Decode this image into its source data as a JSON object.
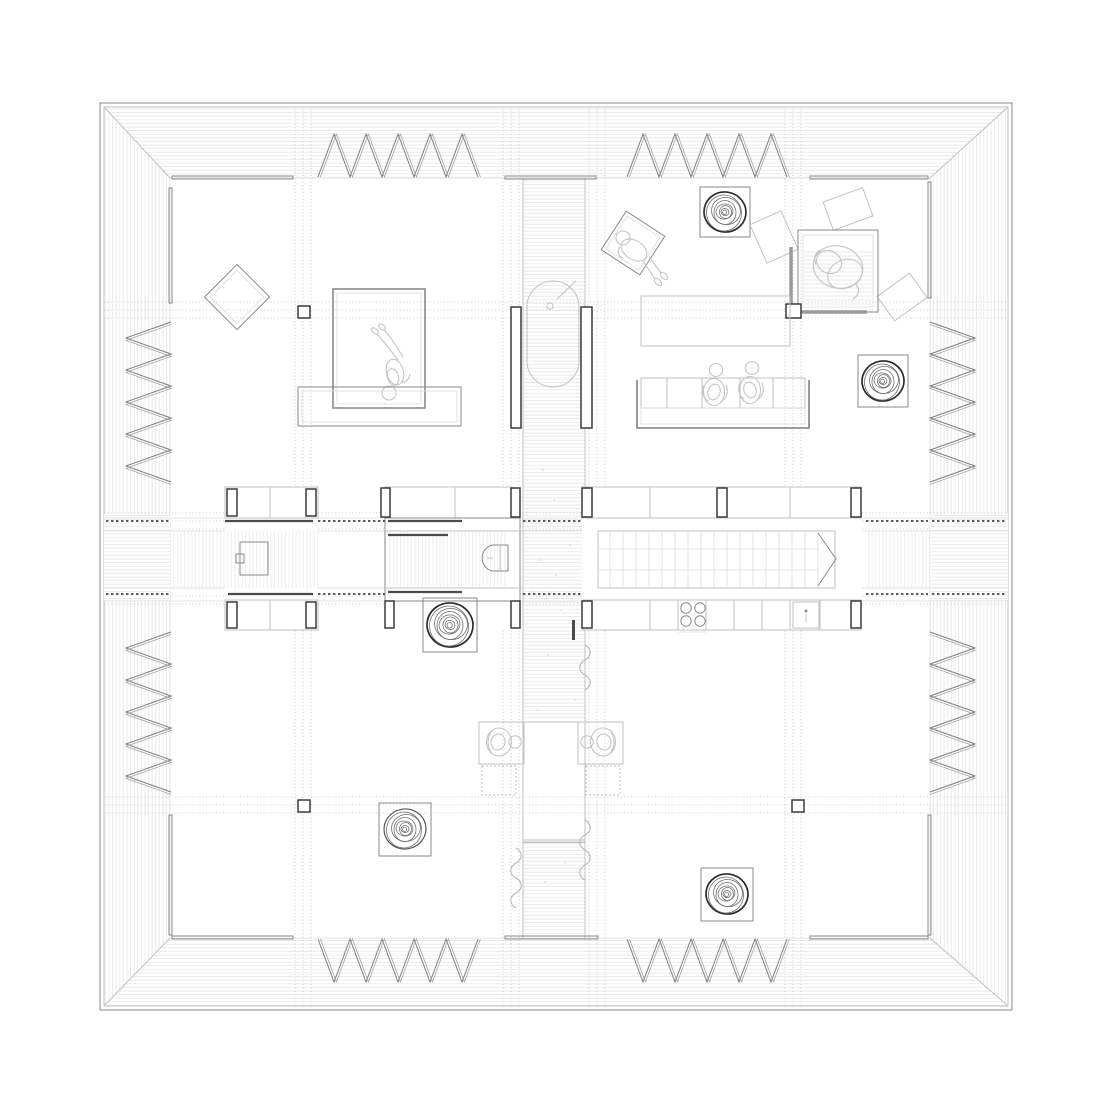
{
  "palette": {
    "background": "#ffffff",
    "ink_dark": "#2b2b2b",
    "ink": "#8a8a8a",
    "ink_light": "#c2c2c2",
    "hatch": "#e2e2e2",
    "grid_dots": "#bdbdbd",
    "people": "#c5c5c5",
    "wall_post": "#3a3a3a"
  },
  "plan": {
    "type": "architectural floor plan, top view, monochrome line drawing, no text labels",
    "building": "square pavilion: deep hatched roof/deck border, inner square floor, central deck corridor, full-width central service band",
    "counts": {
      "louver_screen_groups": 8,
      "louver_teeth_per_group": 5,
      "spiral_rugs": 5,
      "stair_treads": 17,
      "cooktop_burners": 4,
      "people_figures": 6,
      "column_markers": 4,
      "curtain_squiggles": 3,
      "scatter_cushions": 3
    },
    "features": [
      {
        "name": "deck-frame",
        "description": "double-line outer square with hatched eave band and mitred corners"
      },
      {
        "name": "louver-screens",
        "description": "accordion zigzag screens, two groups per side, between eave and glazing line"
      },
      {
        "name": "glazed-sills",
        "description": "short double-line sill segments on the inner wall line"
      },
      {
        "name": "grid-lines",
        "description": "dotted construction grid clusters crossing the plan"
      },
      {
        "name": "central-corridor",
        "description": "vertical plank-hatched deck strip through the whole plan"
      },
      {
        "name": "bathtub",
        "description": "freestanding oval tub on corridor with drain and diagonal faucet, flanked by two dark privacy walls"
      },
      {
        "name": "dining-table",
        "description": "corridor-width table with two facing seated figures and dotted floor cushions"
      },
      {
        "name": "curtains",
        "description": "wavy curtain lines along corridor edges"
      },
      {
        "name": "west-bed",
        "description": "double-line bed with lying figure, low bench below, rotated lounge chair"
      },
      {
        "name": "study-desk",
        "description": "rotated square desk with seated figure, northeast of corridor"
      },
      {
        "name": "living-table",
        "description": "plain rectangular low table"
      },
      {
        "name": "sofa",
        "description": "sectional sofa with two seated figures"
      },
      {
        "name": "northeast-bed",
        "description": "square bed with sheet lines and swirled duvet, L-shaped partition wall with corner column"
      },
      {
        "name": "scatter-cushions",
        "description": "three rotated rectangles near northeast bed"
      },
      {
        "name": "spiral-rugs",
        "description": "five framed round rugs drawn as wobbly concentric rings"
      },
      {
        "name": "service-band",
        "description": "full-width middle band: wardrobe room west, sliding-door bathroom with toilet, long staircase with arrow, kitchen counter with cooktop and sink, upper cabinet rows with dark posts"
      },
      {
        "name": "columns",
        "description": "small square column markers at grid intersections"
      }
    ]
  }
}
